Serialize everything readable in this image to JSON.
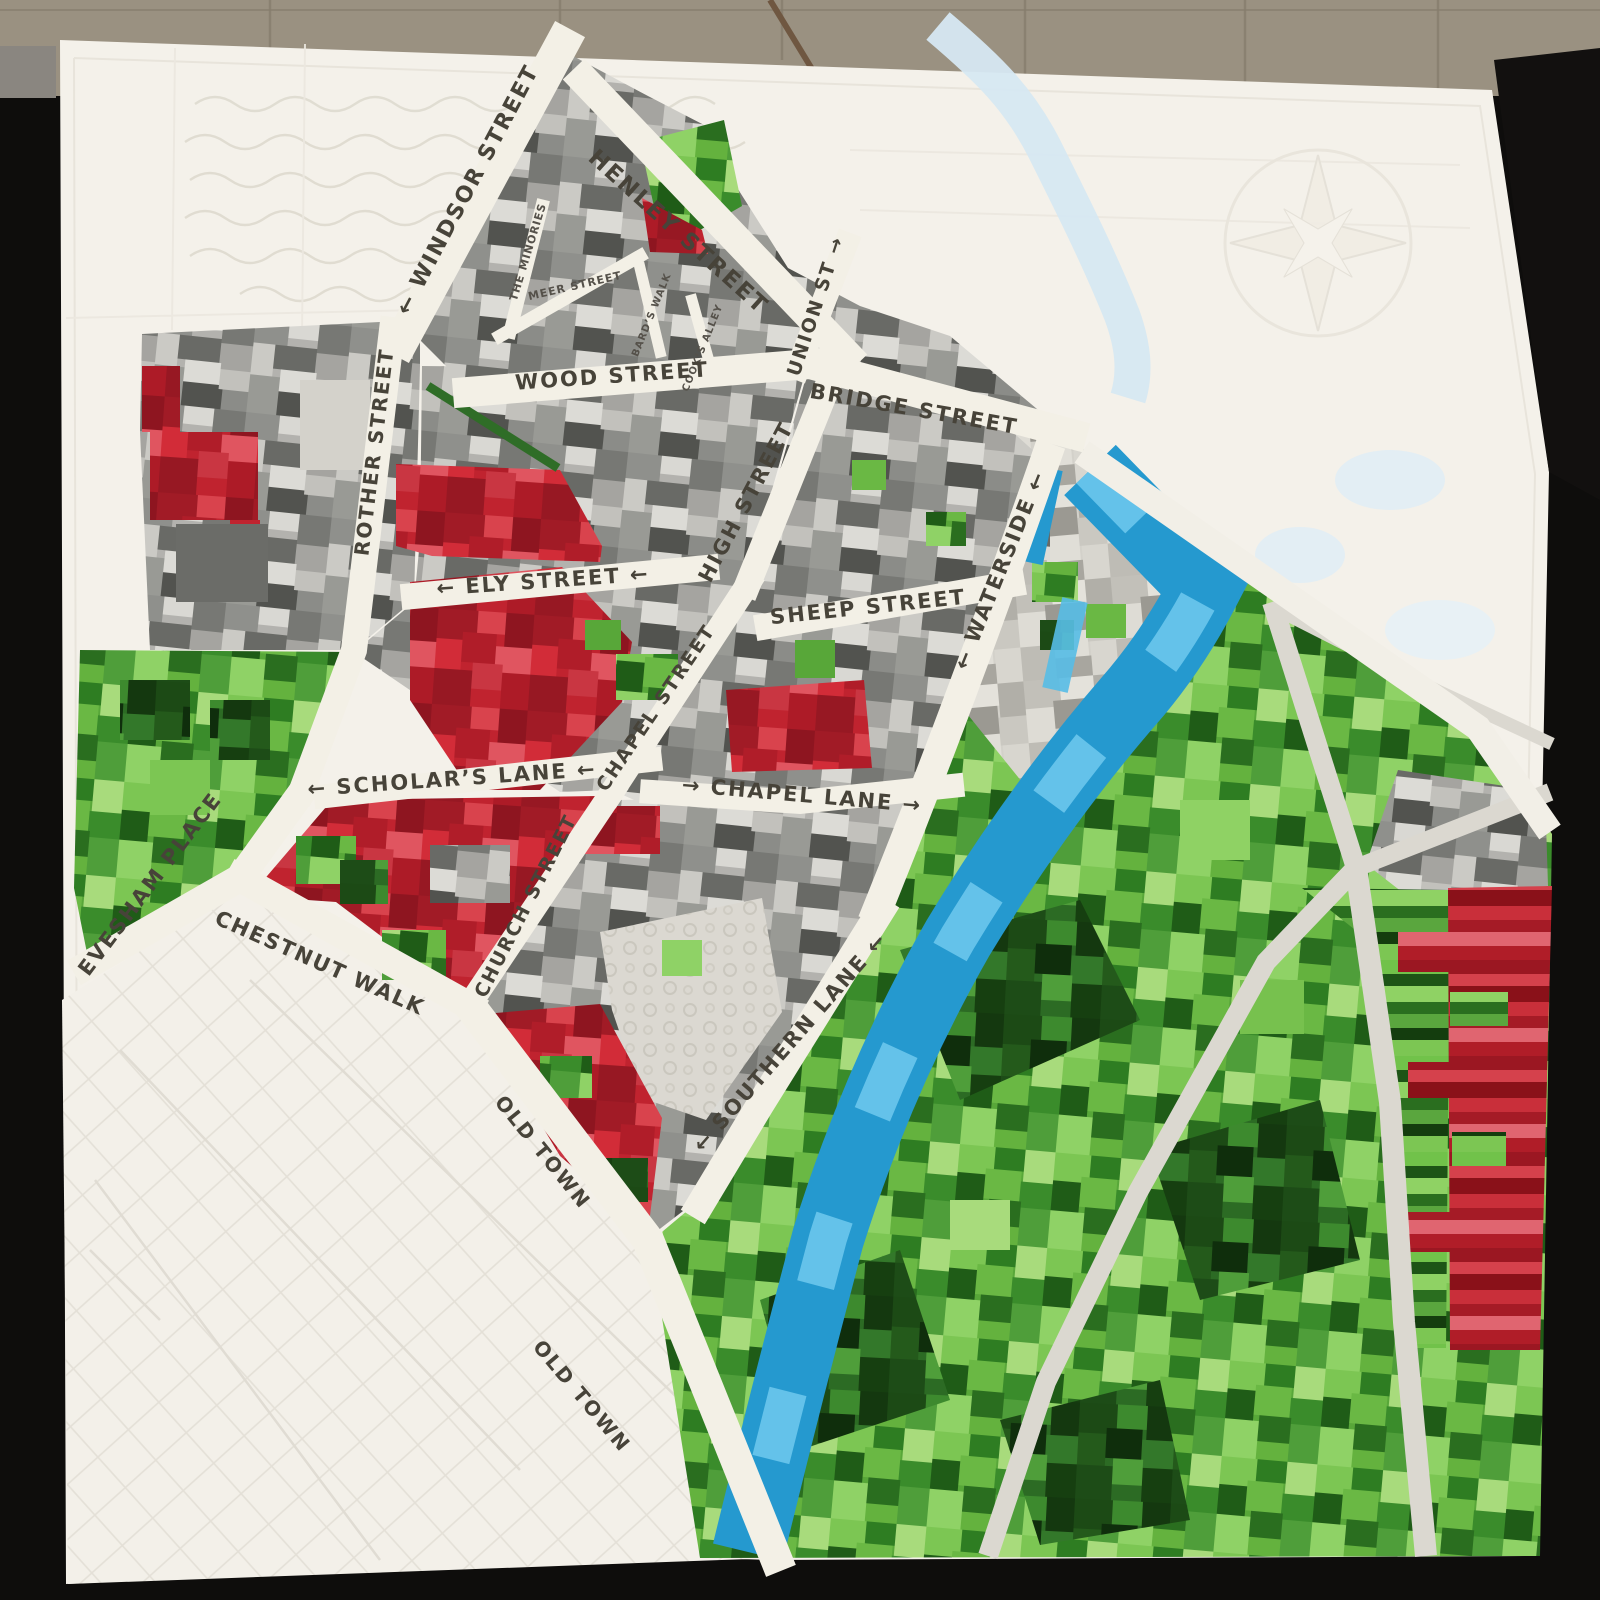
{
  "scene": {
    "subject": "patchwork quilt map of a town, hung against a black wall below tan tiles"
  },
  "colors": {
    "quilt_white": "#f4f1ea",
    "street_cream": "#f3f0e6",
    "town_gray": "#b3b2ae",
    "light_gray": "#d3d1ca",
    "dense_red": "#c0232f",
    "park_green_bright": "#58a739",
    "park_green_dark": "#2c6b24",
    "river_blue": "#2b9fd6",
    "river_blue_light": "#6cc6ec",
    "pale_quilted_river": "#d6e8f2",
    "label_ink": "#474339",
    "wall_tan": "#9a9181",
    "background_black": "#0e0d0c"
  },
  "streets": {
    "windsor": {
      "label": "← WINDSOR STREET"
    },
    "henley": {
      "label": "HENLEY STREET"
    },
    "minories": {
      "label": "THE MINORIES"
    },
    "meer": {
      "label": "MEER STREET"
    },
    "bards": {
      "label": "BARD’S WALK"
    },
    "cooks": {
      "label": "COOK’S ALLEY"
    },
    "union": {
      "label": "UNION ST →"
    },
    "wood": {
      "label": "WOOD STREET"
    },
    "bridge": {
      "label": "BRIDGE STREET"
    },
    "rother": {
      "label": "ROTHER STREET"
    },
    "high": {
      "label": "HIGH STREET"
    },
    "ely": {
      "label": "← ELY STREET ←"
    },
    "sheep": {
      "label": "SHEEP STREET"
    },
    "waterside": {
      "label": "← WATERSIDE ←"
    },
    "chapel_street": {
      "label": "CHAPEL STREET"
    },
    "scholars": {
      "label": "← SCHOLAR’S LANE ←"
    },
    "chapel_lane": {
      "label": "→ CHAPEL LANE →"
    },
    "church": {
      "label": "CHURCH STREET"
    },
    "evesham": {
      "label": "EVESHAM PLACE"
    },
    "chestnut": {
      "label": "CHESTNUT WALK"
    },
    "old_town_1": {
      "label": "OLD TOWN"
    },
    "southern": {
      "label": "← SOUTHERN LANE ←"
    },
    "old_town_2": {
      "label": "OLD TOWN"
    }
  }
}
